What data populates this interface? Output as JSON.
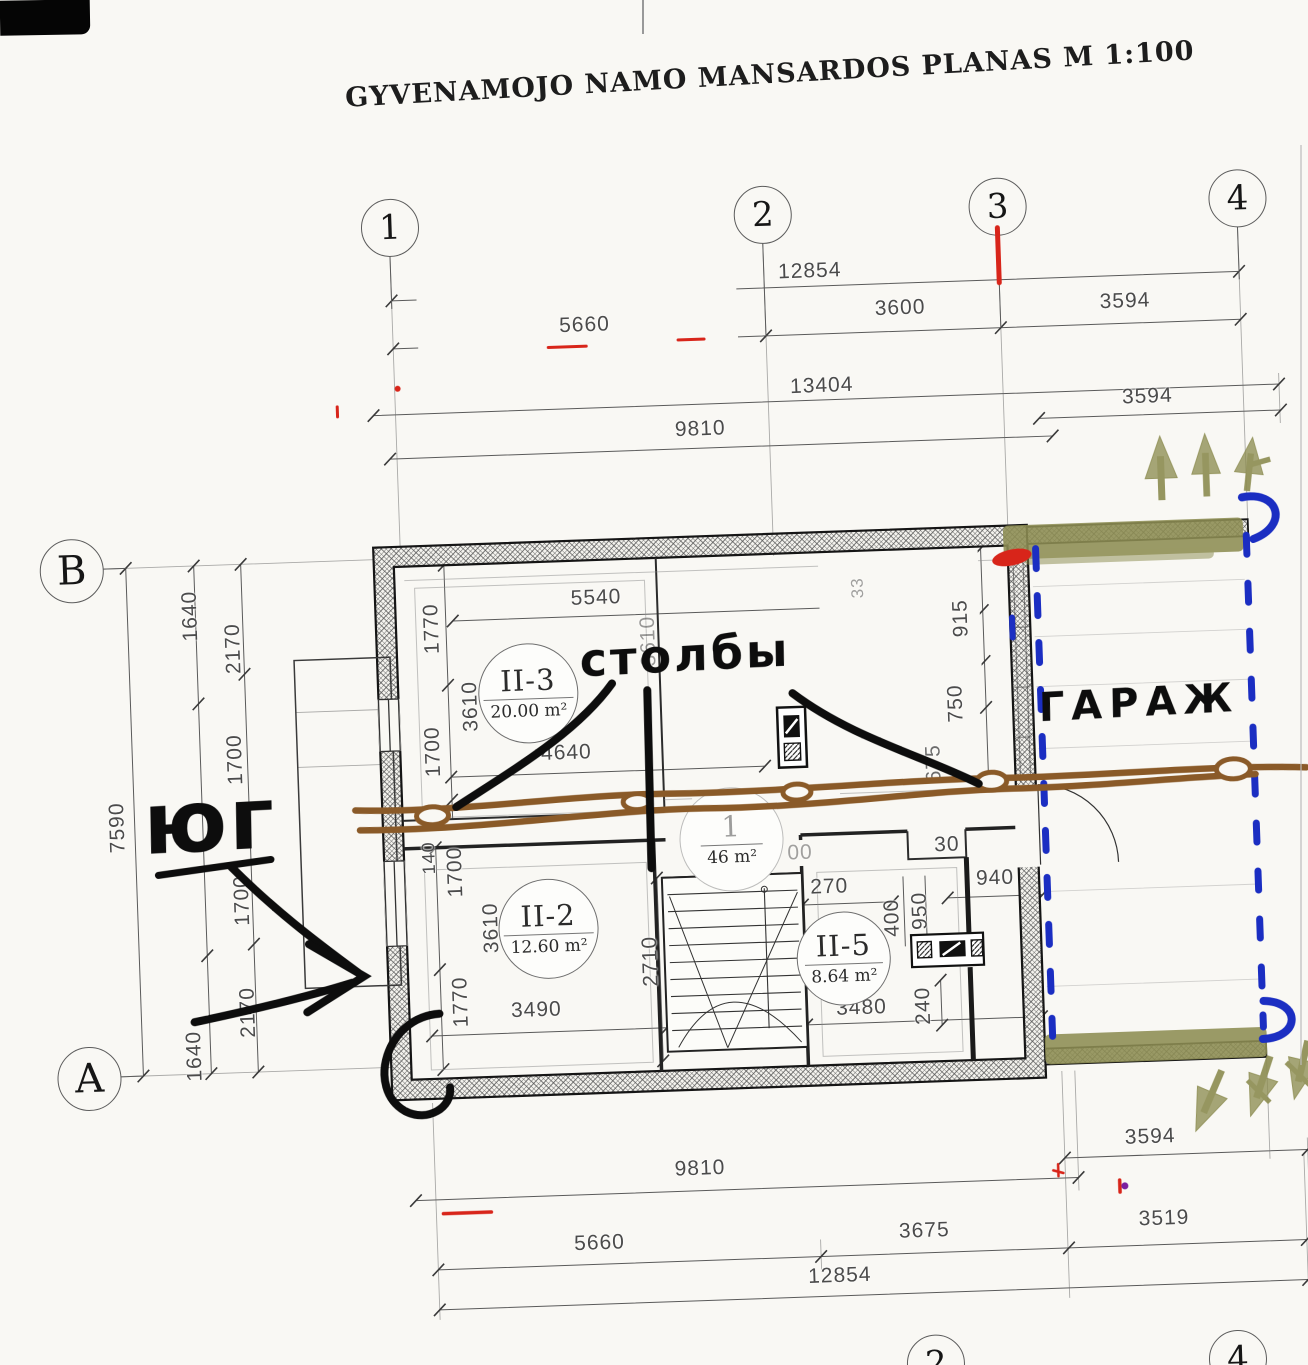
{
  "title": "GYVENAMOJO NAMO MANSARDOS PLANAS M 1:100",
  "colors": {
    "paper": "#f9f8f4",
    "drawing_line": "#5a5a5a",
    "marker_black": "#0d0d0d",
    "marker_brown": "#8a5a28",
    "marker_olive": "#8d8d52",
    "marker_blue": "#1b2ec2",
    "marker_red": "#d8251a"
  },
  "grid": {
    "top_bubbles": [
      {
        "label": "1",
        "x": 405,
        "y": 218
      },
      {
        "label": "2",
        "x": 778,
        "y": 218
      },
      {
        "label": "3",
        "x": 1013,
        "y": 218
      },
      {
        "label": "4",
        "x": 1253,
        "y": 218
      }
    ],
    "bottom_bubbles": [
      {
        "label": "2",
        "x": 911,
        "y": 1372
      },
      {
        "label": "4",
        "x": 1213,
        "y": 1378
      }
    ],
    "row_bubbles": [
      {
        "label": "B",
        "x": 75,
        "y": 550
      },
      {
        "label": "A",
        "x": 75,
        "y": 1058
      }
    ]
  },
  "dim_labels": [
    {
      "t": "12854",
      "x": 824,
      "y": 277
    },
    {
      "t": "5660",
      "x": 597,
      "y": 323
    },
    {
      "t": "3600",
      "x": 913,
      "y": 317
    },
    {
      "t": "3594",
      "x": 1138,
      "y": 318
    },
    {
      "t": "13404",
      "x": 832,
      "y": 392
    },
    {
      "t": "9810",
      "x": 709,
      "y": 431
    },
    {
      "t": "3594",
      "x": 1157,
      "y": 414
    },
    {
      "t": "7590",
      "x": 113,
      "y": 809,
      "r": 1
    },
    {
      "t": "1640",
      "x": 193,
      "y": 600,
      "r": 1
    },
    {
      "t": "2170",
      "x": 235,
      "y": 634,
      "r": 1
    },
    {
      "t": "1700",
      "x": 233,
      "y": 745,
      "r": 1
    },
    {
      "t": "1700",
      "x": 235,
      "y": 886,
      "r": 1
    },
    {
      "t": "2170",
      "x": 237,
      "y": 998,
      "r": 1
    },
    {
      "t": "1640",
      "x": 182,
      "y": 1040,
      "r": 1
    },
    {
      "t": "5540",
      "x": 599,
      "y": 596
    },
    {
      "t": "1770",
      "x": 434,
      "y": 621,
      "r": 1
    },
    {
      "t": "3610",
      "x": 470,
      "y": 700,
      "r": 1
    },
    {
      "t": "1700",
      "x": 431,
      "y": 744,
      "r": 1
    },
    {
      "t": "4640",
      "x": 564,
      "y": 750
    },
    {
      "t": "3610",
      "x": 650,
      "y": 641,
      "r": 1,
      "o": 0.55
    },
    {
      "t": "33",
      "x": 861,
      "y": 595,
      "r": 1,
      "s": 17,
      "o": 0.5
    },
    {
      "t": "915",
      "x": 963,
      "y": 629,
      "r": 1
    },
    {
      "t": "750",
      "x": 955,
      "y": 714,
      "r": 1
    },
    {
      "t": "675",
      "x": 931,
      "y": 773,
      "r": 1,
      "o": 0.8
    },
    {
      "t": "140",
      "x": 423,
      "y": 850,
      "r": 1,
      "s": 18
    },
    {
      "t": "1700",
      "x": 449,
      "y": 865,
      "r": 1
    },
    {
      "t": "3610",
      "x": 483,
      "y": 922,
      "r": 1
    },
    {
      "t": "1770",
      "x": 450,
      "y": 995,
      "r": 1
    },
    {
      "t": "3490",
      "x": 525,
      "y": 1006
    },
    {
      "t": "2710",
      "x": 641,
      "y": 961,
      "r": 1
    },
    {
      "t": "270",
      "x": 822,
      "y": 893
    },
    {
      "t": "00",
      "x": 794,
      "y": 858,
      "o": 0.5
    },
    {
      "t": "30",
      "x": 941,
      "y": 855
    },
    {
      "t": "400",
      "x": 884,
      "y": 926,
      "r": 1
    },
    {
      "t": "950",
      "x": 912,
      "y": 920,
      "r": 1
    },
    {
      "t": "940",
      "x": 988,
      "y": 890
    },
    {
      "t": "240",
      "x": 912,
      "y": 1015,
      "r": 1
    },
    {
      "t": "3480",
      "x": 850,
      "y": 1015
    },
    {
      "t": "9810",
      "x": 683,
      "y": 1170
    },
    {
      "t": "3594",
      "x": 1134,
      "y": 1154
    },
    {
      "t": "5660",
      "x": 580,
      "y": 1241
    },
    {
      "t": "3675",
      "x": 905,
      "y": 1240
    },
    {
      "t": "3519",
      "x": 1145,
      "y": 1236
    },
    {
      "t": "12854",
      "x": 819,
      "y": 1282
    }
  ],
  "rooms": [
    {
      "name": "II-3",
      "area": "20.00 m²",
      "x": 527,
      "y": 688,
      "d": 98
    },
    {
      "name": "II-2",
      "area": "12.60 m²",
      "x": 539,
      "y": 924,
      "d": 98
    },
    {
      "name": "II-5",
      "area": "8.64 m²",
      "x": 833,
      "y": 964,
      "d": 92
    },
    {
      "name": "1",
      "area": "46 m²",
      "x": 725,
      "y": 841,
      "d": 102,
      "faded": true
    }
  ],
  "annotations": {
    "stolby": {
      "text": "столбы",
      "x": 686,
      "y": 656
    },
    "garage": {
      "text": "ГАРАЖ",
      "x": 1138,
      "y": 720
    },
    "south": {
      "text": "юг",
      "x": 205,
      "y": 806
    }
  }
}
